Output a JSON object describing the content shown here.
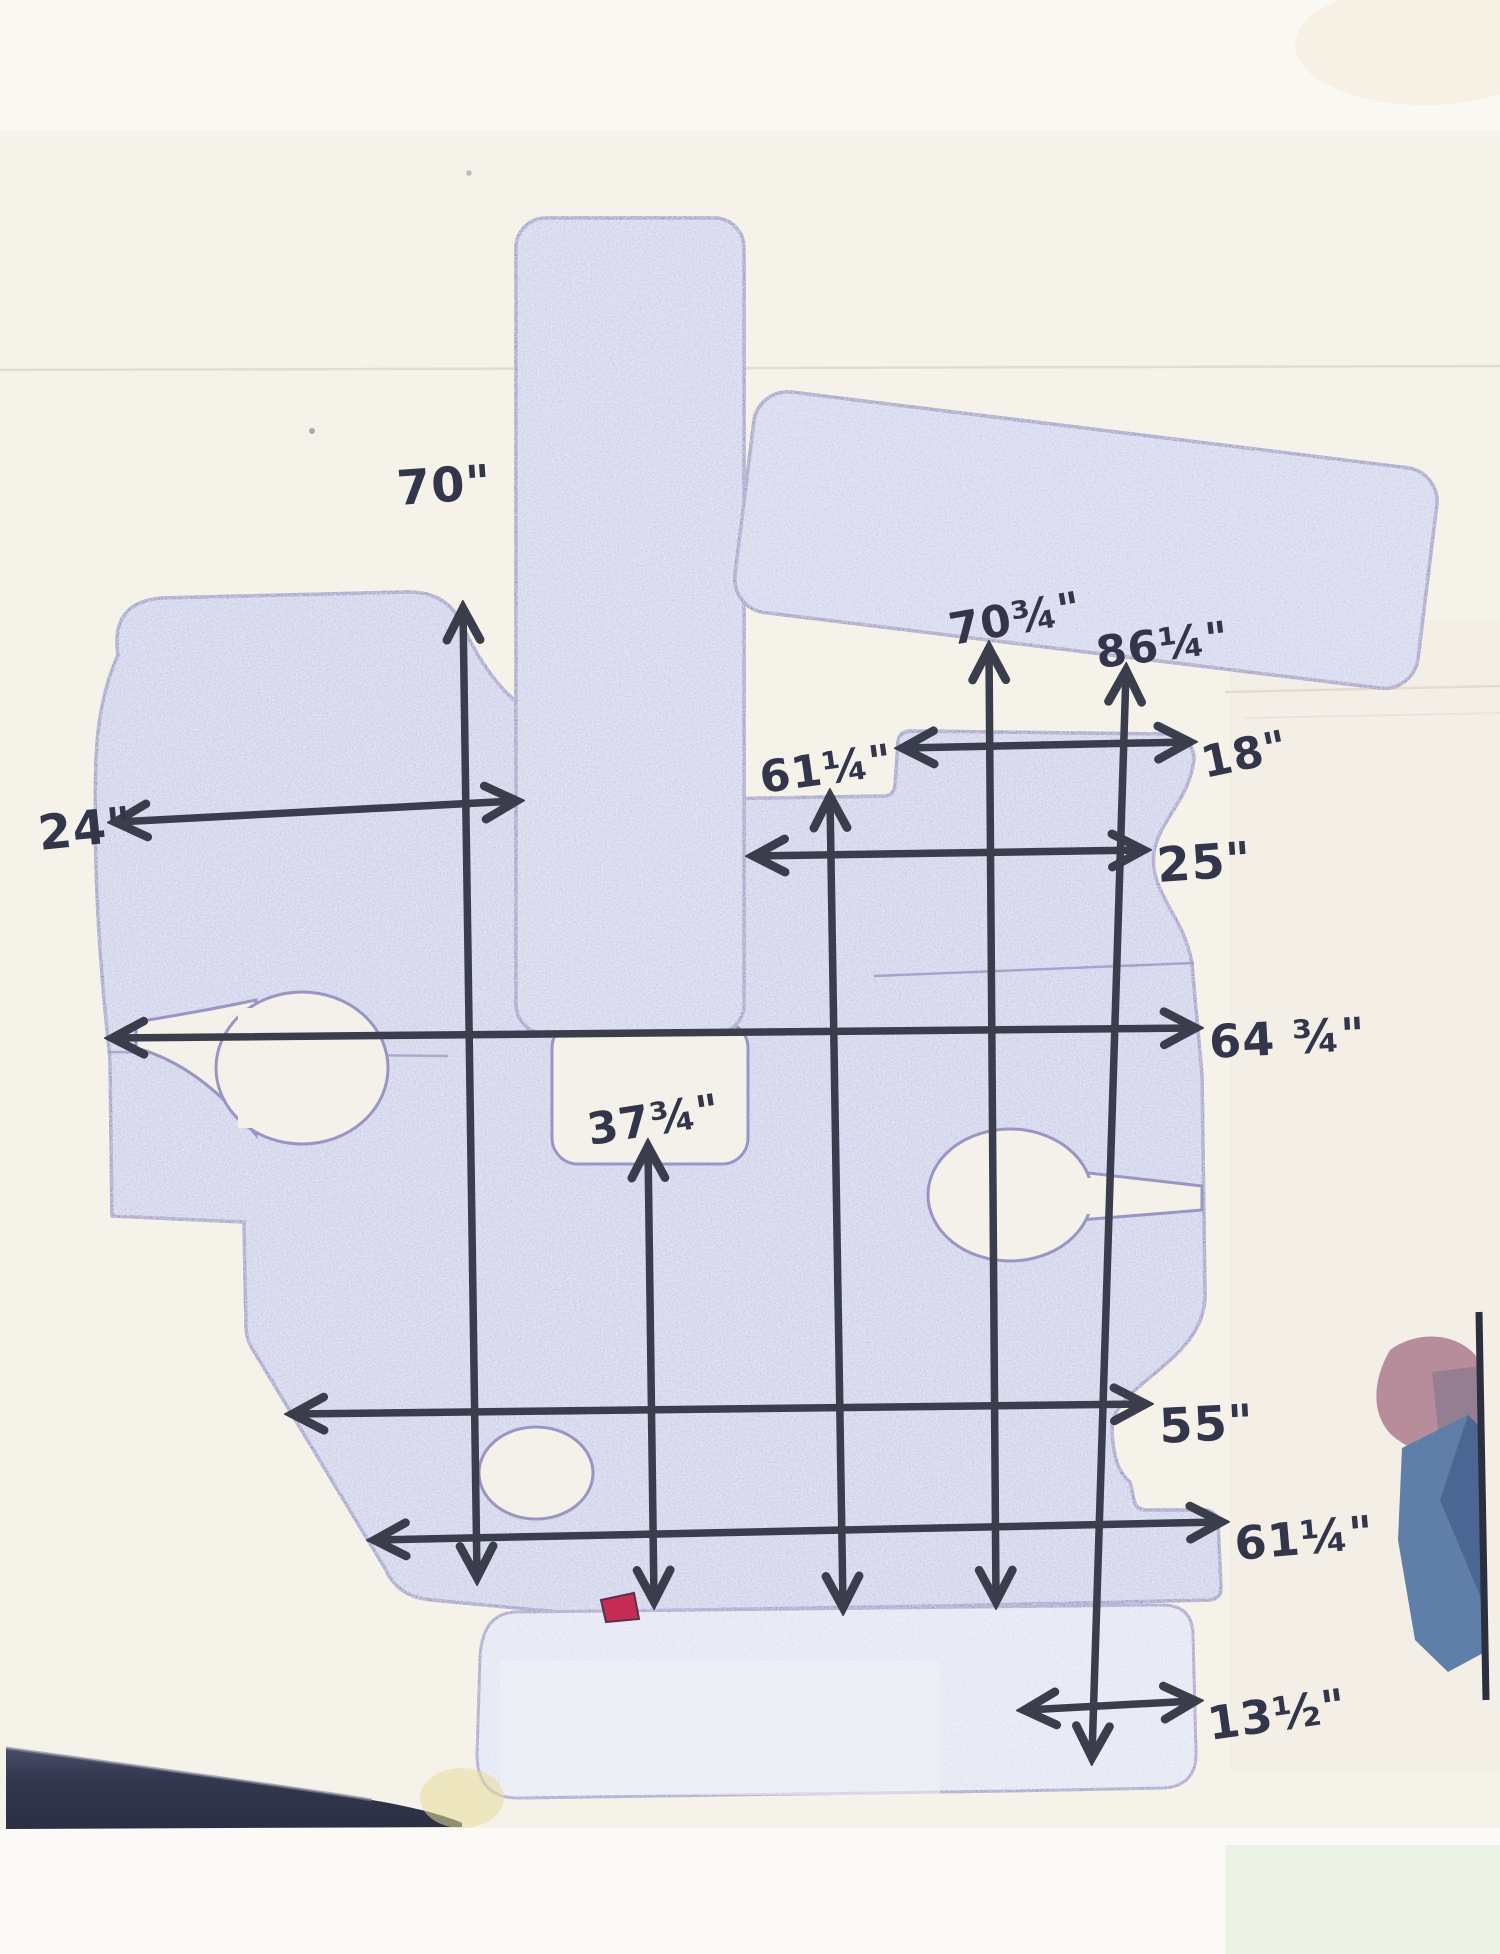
{
  "document_kind": "scanned hand-drawn boat mat / carpet template with handwritten dimensions",
  "measurements": [
    {
      "id": "v-70",
      "text": "70\"",
      "orientation": "vertical"
    },
    {
      "id": "v-70-3-4",
      "text": "70¾\"",
      "orientation": "vertical"
    },
    {
      "id": "v-86-1-4",
      "text": "86¼\"",
      "orientation": "vertical"
    },
    {
      "id": "v-61-1-4",
      "text": "61¼\"",
      "orientation": "vertical"
    },
    {
      "id": "h-18",
      "text": "18\"",
      "orientation": "horizontal"
    },
    {
      "id": "h-24",
      "text": "24\"",
      "orientation": "horizontal"
    },
    {
      "id": "h-25",
      "text": "25\"",
      "orientation": "horizontal"
    },
    {
      "id": "h-64-3-4",
      "text": "64 ¾\"",
      "orientation": "horizontal"
    },
    {
      "id": "v-37-3-4",
      "text": "37¾\"",
      "orientation": "vertical"
    },
    {
      "id": "h-55",
      "text": "55\"",
      "orientation": "horizontal"
    },
    {
      "id": "h-61-1-4",
      "text": "61¼\"",
      "orientation": "horizontal"
    },
    {
      "id": "h-13-1-2",
      "text": "13½\"",
      "orientation": "horizontal"
    }
  ],
  "palette": {
    "paper": "#f5f2ea",
    "mat_fill": "#c7cbe6",
    "mat_outline": "#8a86b5",
    "ink": "#3a3d4c",
    "red_mark": "#c62d55",
    "photo_navy": "#343850",
    "photo_blue": "#5f7fa9",
    "photo_mauve": "#b78d9c"
  }
}
